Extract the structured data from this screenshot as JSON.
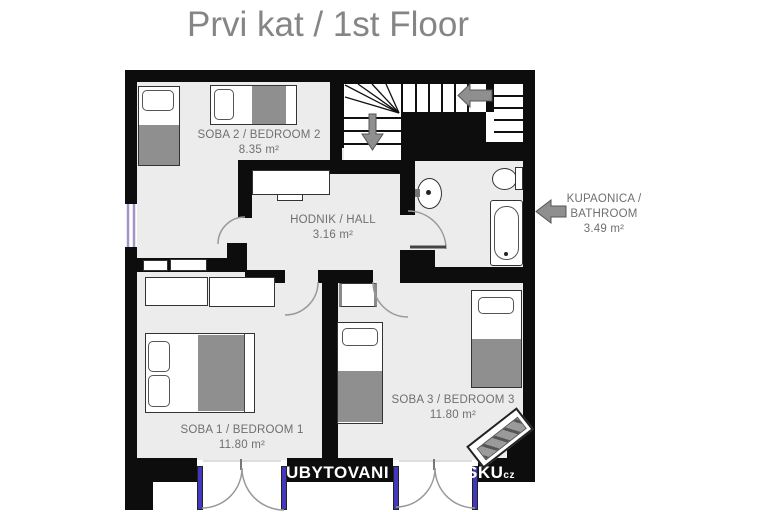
{
  "title": "Prvi kat / 1st Floor",
  "rooms": {
    "bedroom2": {
      "label": "SOBA 2 / BEDROOM 2",
      "area": "8.35 m²"
    },
    "hall": {
      "label": "HODNIK / HALL",
      "area": "3.16 m²"
    },
    "bedroom1": {
      "label": "SOBA 1 / BEDROOM 1",
      "area": "11.80 m²"
    },
    "bedroom3": {
      "label": "SOBA 3 / BEDROOM 3",
      "area": "11.80 m²"
    },
    "bathroom": {
      "label_line1": "KUPAONICA /",
      "label_line2": "BATHROOM",
      "area": "3.49 m²"
    }
  },
  "watermark": {
    "fragment_left": "UBYTOVANI",
    "fragment_right": "SKU",
    "fragment_suffix": "cz"
  },
  "icons": {
    "stairs_down_arrow": "▼",
    "stairs_turn_arrow": "◀",
    "bathroom_pointer_arrow": "◀"
  },
  "colors": {
    "wall": "#0d0d0d",
    "floor": "#ececec",
    "blanket": "#8f8f8f",
    "door_leaf": "#4238bd",
    "window": "#a393c8",
    "arrow": "#8f8f8f",
    "arc": "#999999",
    "label_text": "#6f6f6f",
    "title_text": "#858585",
    "watermark_text": "#ffffff"
  }
}
